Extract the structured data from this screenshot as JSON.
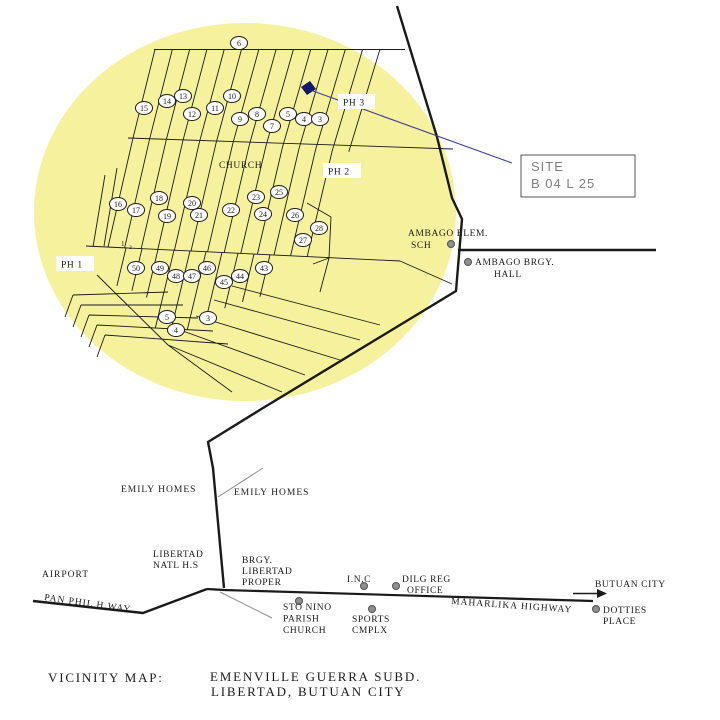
{
  "colors": {
    "highlight_circle": "#f5f19c",
    "ink": "#1a1a1a",
    "navy": "#1c1c70",
    "leader_gray": "#8a8a8a",
    "site_text": "#7f7f7f",
    "dot_fill": "#8f8f8f",
    "dot_stroke": "#4f4f4f"
  },
  "site_callout": {
    "line1": "SITE",
    "line2": "B 04 L 25"
  },
  "phases": {
    "ph1": "PH 1",
    "ph2": "PH 2",
    "ph3": "PH 3"
  },
  "subdivision": {
    "church": "CHURCH",
    "corner_note_1": "1",
    "corner_note_2": "2"
  },
  "lots": [
    {
      "n": "6",
      "x": 239,
      "y": 43
    },
    {
      "n": "15",
      "x": 144,
      "y": 108
    },
    {
      "n": "14",
      "x": 167,
      "y": 101
    },
    {
      "n": "13",
      "x": 183,
      "y": 96
    },
    {
      "n": "12",
      "x": 192,
      "y": 114
    },
    {
      "n": "11",
      "x": 215,
      "y": 108
    },
    {
      "n": "10",
      "x": 232,
      "y": 96
    },
    {
      "n": "9",
      "x": 240,
      "y": 119
    },
    {
      "n": "8",
      "x": 257,
      "y": 114
    },
    {
      "n": "7",
      "x": 272,
      "y": 126
    },
    {
      "n": "5",
      "x": 288,
      "y": 114
    },
    {
      "n": "4",
      "x": 304,
      "y": 119
    },
    {
      "n": "3",
      "x": 320,
      "y": 119
    },
    {
      "n": "16",
      "x": 118,
      "y": 204
    },
    {
      "n": "17",
      "x": 136,
      "y": 210
    },
    {
      "n": "18",
      "x": 159,
      "y": 198
    },
    {
      "n": "19",
      "x": 167,
      "y": 216
    },
    {
      "n": "20",
      "x": 192,
      "y": 203
    },
    {
      "n": "21",
      "x": 199,
      "y": 215
    },
    {
      "n": "22",
      "x": 231,
      "y": 210
    },
    {
      "n": "23",
      "x": 256,
      "y": 197
    },
    {
      "n": "24",
      "x": 263,
      "y": 214
    },
    {
      "n": "25",
      "x": 279,
      "y": 192
    },
    {
      "n": "26",
      "x": 295,
      "y": 215
    },
    {
      "n": "27",
      "x": 303,
      "y": 240
    },
    {
      "n": "28",
      "x": 319,
      "y": 228
    },
    {
      "n": "50",
      "x": 136,
      "y": 268
    },
    {
      "n": "49",
      "x": 160,
      "y": 268
    },
    {
      "n": "48",
      "x": 176,
      "y": 276
    },
    {
      "n": "47",
      "x": 192,
      "y": 276
    },
    {
      "n": "46",
      "x": 207,
      "y": 268
    },
    {
      "n": "45",
      "x": 224,
      "y": 282
    },
    {
      "n": "44",
      "x": 240,
      "y": 276
    },
    {
      "n": "43",
      "x": 264,
      "y": 268
    },
    {
      "n": "5",
      "x": 167,
      "y": 317
    },
    {
      "n": "4",
      "x": 176,
      "y": 330
    },
    {
      "n": "3",
      "x": 208,
      "y": 318
    }
  ],
  "dots": [
    {
      "name": "ambago-elem-dot",
      "x": 451,
      "y": 244
    },
    {
      "name": "ambago-brgy-dot",
      "x": 468,
      "y": 262
    },
    {
      "name": "sto-nino-dot",
      "x": 299,
      "y": 601
    },
    {
      "name": "inc-dot",
      "x": 364,
      "y": 586
    },
    {
      "name": "dilg-dot",
      "x": 396,
      "y": 586
    },
    {
      "name": "sports-dot",
      "x": 372,
      "y": 609
    },
    {
      "name": "dotties-dot",
      "x": 596,
      "y": 609
    }
  ],
  "pois": {
    "ambago_elem": {
      "line1": "AMBAGO ELEM.",
      "line2": "SCH"
    },
    "ambago_brgy": {
      "line1": "AMBAGO BRGY.",
      "line2": "HALL"
    },
    "emily_left": "EMILY HOMES",
    "emily_right": "EMILY HOMES",
    "libertad_hs": {
      "line1": "LIBERTAD",
      "line2": "NATL H.S"
    },
    "brgy_libertad": {
      "line1": "BRGY.",
      "line2": "LIBERTAD",
      "line3": "PROPER"
    },
    "airport": "AIRPORT",
    "panphil": "PAN PHIL H.WAY",
    "sto_nino": {
      "line1": "STO NINO",
      "line2": "PARISH",
      "line3": "CHURCH"
    },
    "inc": "I.N.C",
    "dilg": {
      "line1": "DILG REG",
      "line2": "OFFICE"
    },
    "sports": {
      "line1": "SPORTS",
      "line2": "CMPLX"
    },
    "maharlika": "MAHARLIKA HIGHWAY",
    "butuan": "BUTUAN CITY",
    "dotties": {
      "line1": "DOTTIES",
      "line2": "PLACE"
    }
  },
  "caption": {
    "title": "VICINITY MAP:",
    "line1": "EMENVILLE GUERRA SUBD.",
    "line2": "LIBERTAD, BUTUAN CITY"
  }
}
